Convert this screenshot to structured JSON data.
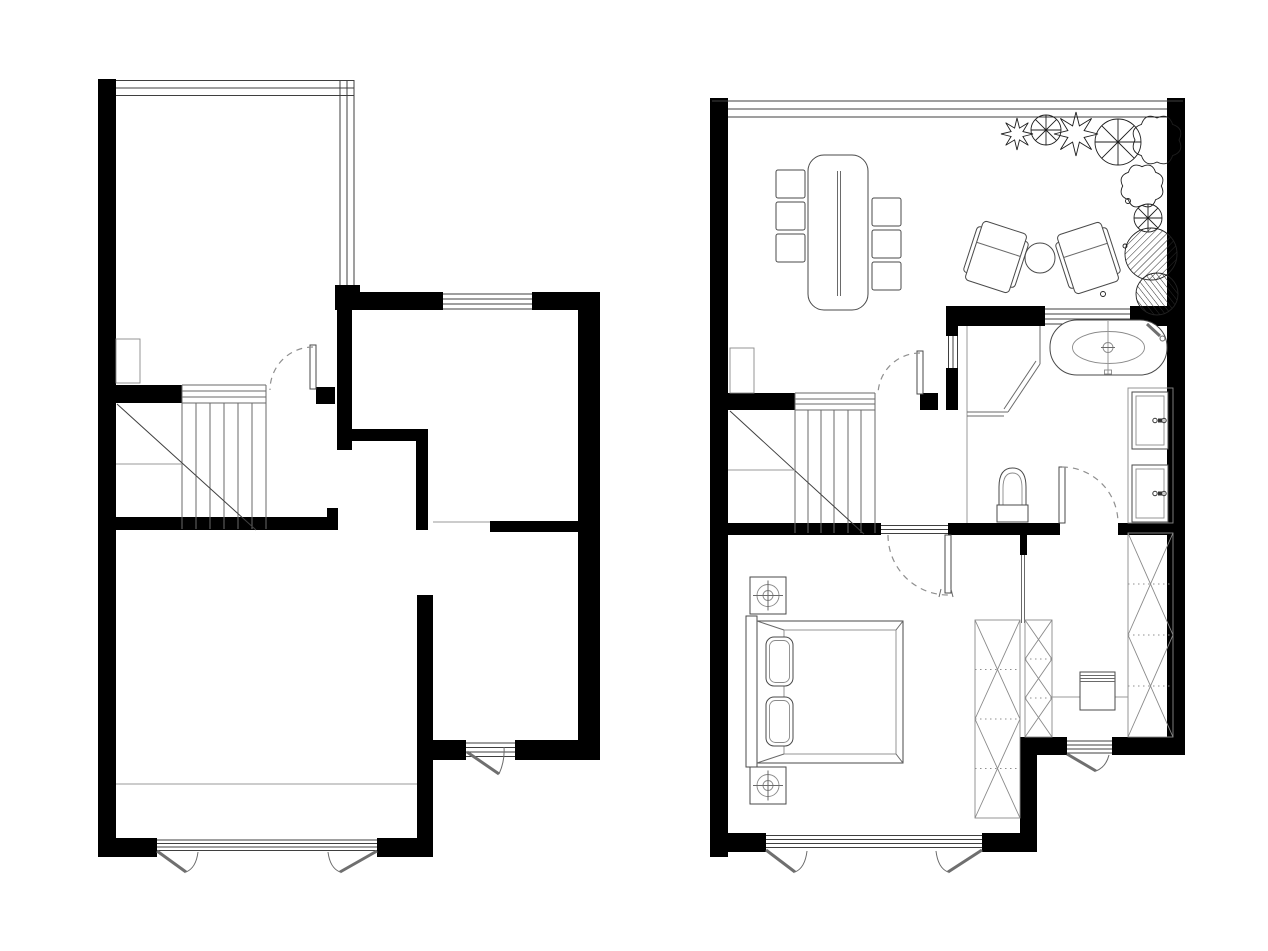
{
  "document": {
    "kind": "architectural floor plan drawing, two plans side by side, no text labels",
    "background": "#ffffff",
    "palette": {
      "walls": "#000000",
      "lines_dark": "#3f3f3f",
      "lines_medium": "#6a6a6a",
      "lines_light": "#9a9a9a",
      "dashed_door_arcs": "#8f8f8f"
    }
  },
  "plan_left": {
    "aria": "Left floor plan: unfurnished level with glazed conservatory at top, staircase hall with quarter-turn door, two rooms on the right and a large room at the bottom with double casement french window and a small garden door",
    "rooms": [
      "conservatory",
      "stair-hall",
      "upper-right-room",
      "lower-right-room",
      "bottom-room"
    ],
    "windows": 3,
    "doors": 3,
    "staircase_treads": 6
  },
  "plan_right": {
    "aria": "Right floor plan: furnished level with glazed terrace (dining table with six chairs, two lounge chairs, round side table, planting bed), staircase hall, bathroom with oval bathtub, corner shower, toilet and double vanity, bedroom with double bed, nightstands and lamps, wardrobes and dressing room with bench",
    "rooms": [
      "terrace-living",
      "stair-hall",
      "bathroom",
      "bedroom",
      "dressing-room"
    ],
    "dining_chairs": 6,
    "lounge_chairs": 2,
    "side_tables": 1,
    "plants": 9,
    "bathtub": 1,
    "shower": 1,
    "toilet": 1,
    "vanity_sinks": 2,
    "bed": 1,
    "pillows": 2,
    "nightstands": 2,
    "table_lamps": 2,
    "wardrobes": 3,
    "bench": 1,
    "staircase_treads": 6
  }
}
